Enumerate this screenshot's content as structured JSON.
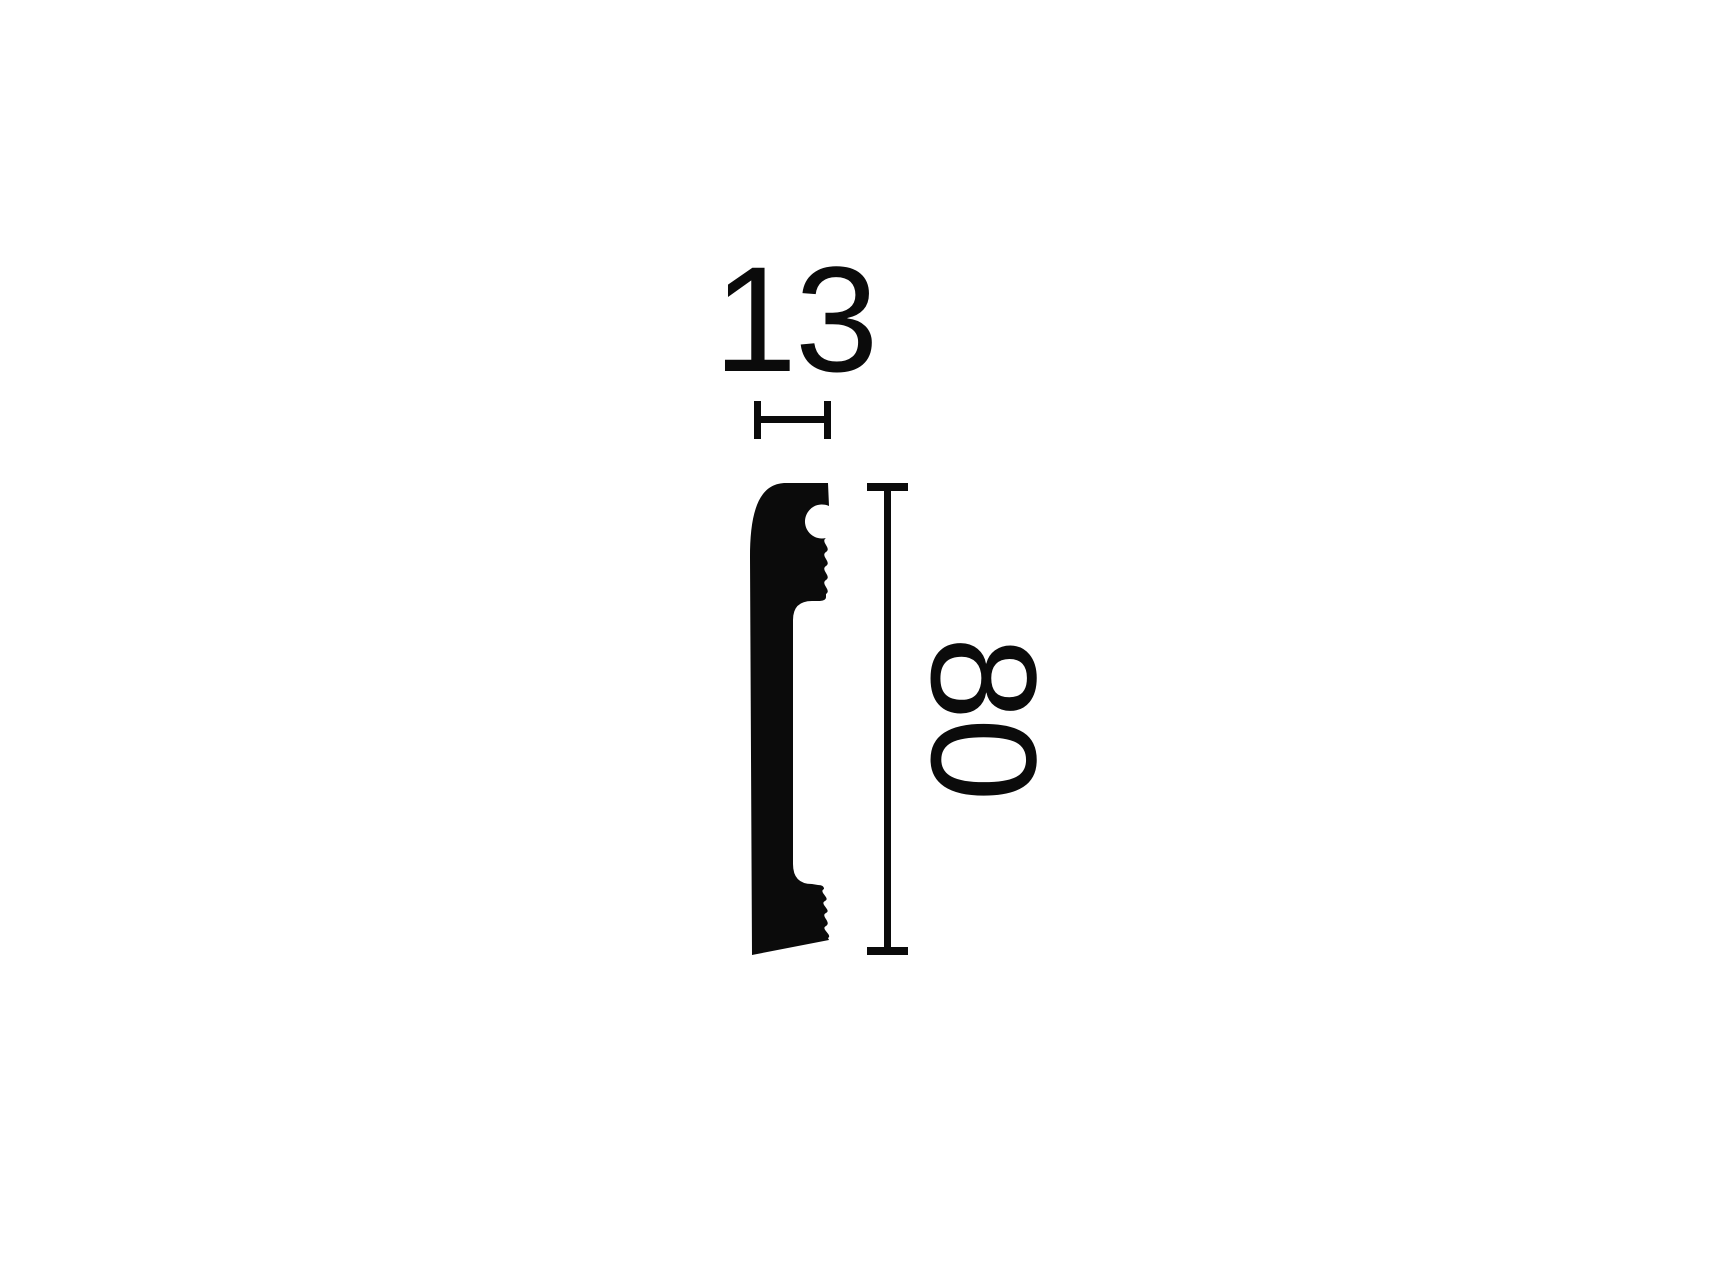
{
  "drawing": {
    "type": "moulding-profile-cross-section",
    "width_dimension": {
      "label": "13"
    },
    "height_dimension": {
      "label": "80"
    },
    "colors": {
      "ink": "#0b0b0b",
      "background": "#ffffff"
    }
  }
}
